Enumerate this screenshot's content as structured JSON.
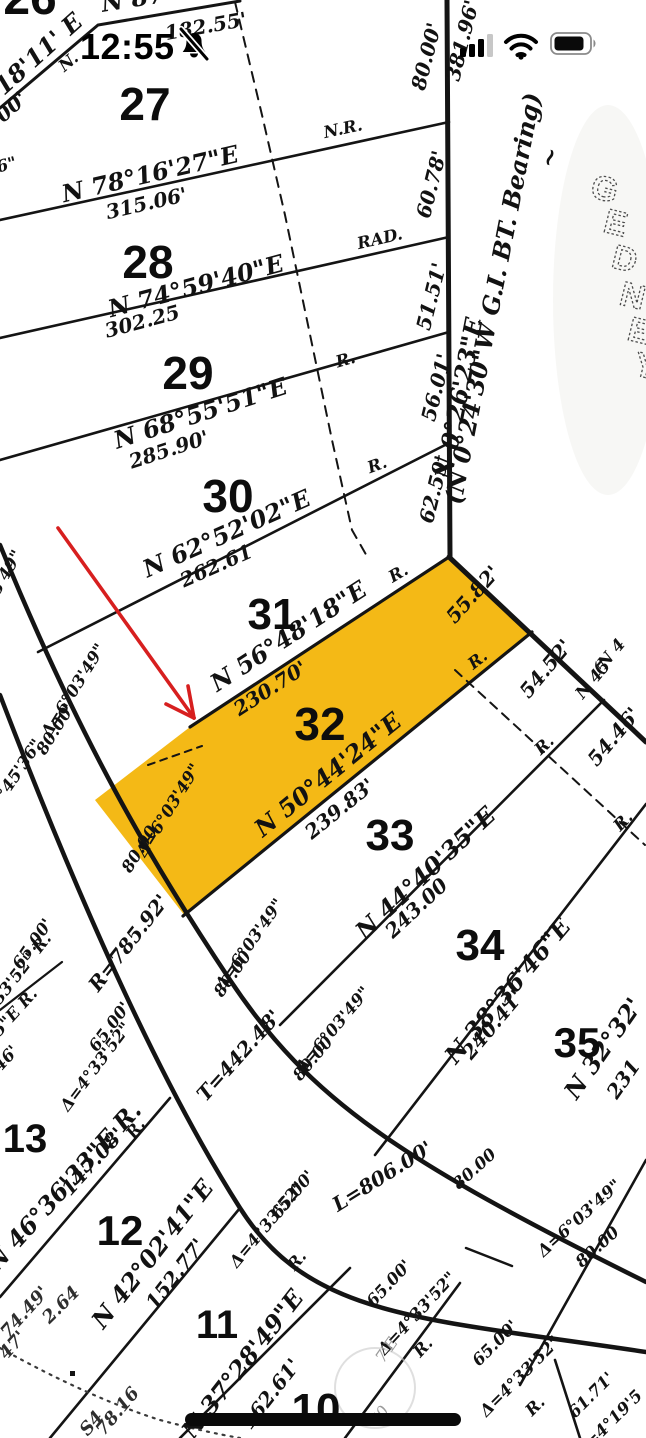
{
  "status_bar": {
    "time": "12:55",
    "icons": [
      "bell-slash-icon",
      "cellular-signal-icon",
      "wifi-icon",
      "battery-icon"
    ]
  },
  "map": {
    "type": "survey-plat-map",
    "highlighted_lot": "32",
    "highlight_color": "#F4B60C",
    "arrow_color": "#D71F1F",
    "street_letters": [
      {
        "t": "G",
        "x": 602,
        "y": 200,
        "r": 14
      },
      {
        "t": "E",
        "x": 613,
        "y": 234,
        "r": 14
      },
      {
        "t": "D",
        "x": 622,
        "y": 270,
        "r": 14
      },
      {
        "t": "N",
        "x": 630,
        "y": 307,
        "r": 14
      },
      {
        "t": "E",
        "x": 637,
        "y": 342,
        "r": 14
      },
      {
        "t": "Y",
        "x": 643,
        "y": 377,
        "r": 14
      }
    ],
    "lots": [
      {
        "t": "26",
        "x": 30,
        "y": 14,
        "s": 48
      },
      {
        "t": "27",
        "x": 145,
        "y": 120,
        "s": 46
      },
      {
        "t": "28",
        "x": 148,
        "y": 278,
        "s": 46
      },
      {
        "t": "29",
        "x": 188,
        "y": 389,
        "s": 46
      },
      {
        "t": "30",
        "x": 228,
        "y": 512,
        "s": 46
      },
      {
        "t": "31",
        "x": 272,
        "y": 629,
        "s": 44
      },
      {
        "t": "32",
        "x": 320,
        "y": 740,
        "s": 46
      },
      {
        "t": "33",
        "x": 390,
        "y": 850,
        "s": 44
      },
      {
        "t": "34",
        "x": 480,
        "y": 960,
        "s": 44
      },
      {
        "t": "35",
        "x": 577,
        "y": 1057,
        "s": 42
      },
      {
        "t": "13",
        "x": 25,
        "y": 1152,
        "s": 40
      },
      {
        "t": "12",
        "x": 120,
        "y": 1245,
        "s": 42
      },
      {
        "t": "11",
        "x": 217,
        "y": 1338,
        "s": 40
      },
      {
        "t": "10",
        "x": 316,
        "y": 1424,
        "s": 44
      }
    ],
    "texts": [
      {
        "t": "N 87°",
        "x": 140,
        "y": 6,
        "r": -9,
        "c": "b"
      },
      {
        "t": "182.55'",
        "x": 207,
        "y": 33,
        "r": -10,
        "c": "l"
      },
      {
        "t": "18'11' E",
        "x": 44,
        "y": 60,
        "r": -42,
        "c": "b"
      },
      {
        "t": "00'",
        "x": 16,
        "y": 112,
        "r": -42,
        "c": "l"
      },
      {
        "t": "N.",
        "x": 72,
        "y": 66,
        "r": -40,
        "c": "s"
      },
      {
        "t": "6\"",
        "x": 8,
        "y": 170,
        "r": -15,
        "c": "s"
      },
      {
        "t": "N 78°16'27\"E",
        "x": 152,
        "y": 182,
        "r": -13,
        "c": "b"
      },
      {
        "t": "315.06'",
        "x": 148,
        "y": 210,
        "r": -13,
        "c": "l"
      },
      {
        "t": "N.R.",
        "x": 344,
        "y": 134,
        "r": -12,
        "c": "s"
      },
      {
        "t": "N 74°59'40\"E",
        "x": 198,
        "y": 294,
        "r": -15,
        "c": "b"
      },
      {
        "t": "302.25",
        "x": 144,
        "y": 328,
        "r": -15,
        "c": "l"
      },
      {
        "t": "RAD.",
        "x": 381,
        "y": 244,
        "r": -13,
        "c": "s"
      },
      {
        "t": "N 68°55'51\"E",
        "x": 203,
        "y": 421,
        "r": -18,
        "c": "b"
      },
      {
        "t": "285.90'",
        "x": 171,
        "y": 456,
        "r": -18,
        "c": "l"
      },
      {
        "t": "R.",
        "x": 347,
        "y": 365,
        "r": -16,
        "c": "s"
      },
      {
        "t": "N 62°52'02\"E",
        "x": 230,
        "y": 541,
        "r": -24,
        "c": "b"
      },
      {
        "t": "262.61",
        "x": 219,
        "y": 572,
        "r": -24,
        "c": "l"
      },
      {
        "t": "R.",
        "x": 379,
        "y": 470,
        "r": -20,
        "c": "s"
      },
      {
        "t": "N 56°48'18\"E",
        "x": 293,
        "y": 643,
        "r": -33,
        "c": "b"
      },
      {
        "t": "230.70'",
        "x": 274,
        "y": 694,
        "r": -33,
        "c": "l"
      },
      {
        "t": "R.",
        "x": 401,
        "y": 578,
        "r": -30,
        "c": "s"
      },
      {
        "t": "N 50°44'24\"E",
        "x": 333,
        "y": 781,
        "r": -39,
        "c": "b"
      },
      {
        "t": "239.83'",
        "x": 344,
        "y": 814,
        "r": -39,
        "c": "l"
      },
      {
        "t": "R.",
        "x": 481,
        "y": 664,
        "r": -38,
        "c": "s"
      },
      {
        "t": "N 44°40'35\"E",
        "x": 431,
        "y": 879,
        "r": -43,
        "c": "b"
      },
      {
        "t": "243.00",
        "x": 421,
        "y": 913,
        "r": -43,
        "c": "l"
      },
      {
        "t": "R.",
        "x": 548,
        "y": 749,
        "r": -43,
        "c": "s"
      },
      {
        "t": "N 38°36'46\"E",
        "x": 514,
        "y": 996,
        "r": -50,
        "c": "b"
      },
      {
        "t": "240.41'",
        "x": 498,
        "y": 1029,
        "r": -50,
        "c": "l"
      },
      {
        "t": "R.",
        "x": 627,
        "y": 825,
        "r": -46,
        "c": "s"
      },
      {
        "t": "N 32°32'",
        "x": 610,
        "y": 1053,
        "r": -55,
        "c": "b"
      },
      {
        "t": "231",
        "x": 629,
        "y": 1083,
        "r": -55,
        "c": "l"
      },
      {
        "t": "55.82'",
        "x": 478,
        "y": 599,
        "r": -48,
        "c": "l"
      },
      {
        "t": "54.52'",
        "x": 551,
        "y": 673,
        "r": -50,
        "c": "l"
      },
      {
        "t": "54.46'",
        "x": 619,
        "y": 741,
        "r": -50,
        "c": "l"
      },
      {
        "t": "(N 4",
        "x": 613,
        "y": 660,
        "r": -50,
        "c": "s"
      },
      {
        "t": "N 45",
        "x": 597,
        "y": 683,
        "r": -50,
        "c": "s"
      },
      {
        "t": "80.00'",
        "x": 433,
        "y": 58,
        "r": -76,
        "c": "l"
      },
      {
        "t": "60.78'",
        "x": 438,
        "y": 186,
        "r": -76,
        "c": "l"
      },
      {
        "t": "51.51'",
        "x": 438,
        "y": 298,
        "r": -76,
        "c": "l"
      },
      {
        "t": "56.01'",
        "x": 443,
        "y": 389,
        "r": -76,
        "c": "l"
      },
      {
        "t": "62.59'",
        "x": 441,
        "y": 491,
        "r": -76,
        "c": "l"
      },
      {
        "t": "381.96'",
        "x": 469,
        "y": 42,
        "r": -76,
        "c": "l"
      },
      {
        "t": "N 0°26'23\"E",
        "x": 467,
        "y": 400,
        "r": -79,
        "c": "b"
      },
      {
        "t": "(N 0°24'30\"W   G.I. BT. Bearing)",
        "x": 501,
        "y": 300,
        "r": -79,
        "c": "b"
      },
      {
        "t": "~",
        "x": 557,
        "y": 160,
        "r": -70,
        "c": "b"
      },
      {
        "t": "R=785.92'",
        "x": 134,
        "y": 947,
        "r": -52,
        "c": "l"
      },
      {
        "t": "T=442.48'",
        "x": 244,
        "y": 1060,
        "r": -48,
        "c": "l"
      },
      {
        "t": "L=806.00'",
        "x": 386,
        "y": 1182,
        "r": -32,
        "c": "l"
      },
      {
        "t": "Δ=6°03'49\"",
        "x": 78,
        "y": 693,
        "r": -58,
        "c": "s"
      },
      {
        "t": "80.00'",
        "x": 60,
        "y": 732,
        "r": -58,
        "c": "s"
      },
      {
        "t": "Δ=6°03'49\"",
        "x": 173,
        "y": 813,
        "r": -58,
        "c": "s"
      },
      {
        "t": "80.00",
        "x": 144,
        "y": 852,
        "r": -58,
        "c": "s"
      },
      {
        "t": "Δ=6°03'49\"",
        "x": 254,
        "y": 947,
        "r": -55,
        "c": "s"
      },
      {
        "t": "80.00",
        "x": 237,
        "y": 977,
        "r": -55,
        "c": "s"
      },
      {
        "t": "Δ=6°03'49\"",
        "x": 337,
        "y": 1033,
        "r": -50,
        "c": "s"
      },
      {
        "t": "80.00",
        "x": 317,
        "y": 1062,
        "r": -50,
        "c": "s"
      },
      {
        "t": "80.00",
        "x": 478,
        "y": 1173,
        "r": -42,
        "c": "s"
      },
      {
        "t": "Δ=6°03'49\"",
        "x": 583,
        "y": 1222,
        "r": -42,
        "c": "s"
      },
      {
        "t": "80.00",
        "x": 601,
        "y": 1251,
        "r": -42,
        "c": "s"
      },
      {
        "t": "03'49\"",
        "x": 8,
        "y": 580,
        "r": -60,
        "c": "s"
      },
      {
        "t": "°45'36\"",
        "x": 24,
        "y": 772,
        "r": -56,
        "c": "s"
      },
      {
        "t": "65.00'",
        "x": 37,
        "y": 947,
        "r": -55,
        "c": "s"
      },
      {
        "t": "33'52\" R.",
        "x": 26,
        "y": 972,
        "r": -52,
        "c": "s"
      },
      {
        "t": "25\"E R.",
        "x": 15,
        "y": 1020,
        "r": -48,
        "c": "s"
      },
      {
        "t": "46'",
        "x": 10,
        "y": 1062,
        "r": -48,
        "c": "s"
      },
      {
        "t": "65.00'",
        "x": 114,
        "y": 1030,
        "r": -53,
        "c": "s"
      },
      {
        "t": "Δ=4°33'52\"",
        "x": 100,
        "y": 1070,
        "r": -53,
        "c": "s"
      },
      {
        "t": "R.",
        "x": 140,
        "y": 1132,
        "r": -53,
        "c": "s"
      },
      {
        "t": "N 46°36'33\"E R.",
        "x": 70,
        "y": 1192,
        "r": -48,
        "c": "b"
      },
      {
        "t": "147.08'",
        "x": 98,
        "y": 1166,
        "r": -48,
        "c": "l"
      },
      {
        "t": "N 42°02'41\"E",
        "x": 159,
        "y": 1259,
        "r": -52,
        "c": "b"
      },
      {
        "t": "152.77'",
        "x": 181,
        "y": 1278,
        "r": -52,
        "c": "l"
      },
      {
        "t": "65.00'",
        "x": 297,
        "y": 1198,
        "r": -50,
        "c": "s"
      },
      {
        "t": "Δ=4°33'52\"",
        "x": 271,
        "y": 1228,
        "r": -50,
        "c": "s"
      },
      {
        "t": "R.",
        "x": 301,
        "y": 1264,
        "r": -50,
        "c": "s"
      },
      {
        "t": "N 37°28'49\"E",
        "x": 249,
        "y": 1369,
        "r": -52,
        "c": "b"
      },
      {
        "t": "162.61'",
        "x": 276,
        "y": 1398,
        "r": -52,
        "c": "l"
      },
      {
        "t": "65.00'",
        "x": 393,
        "y": 1287,
        "r": -47,
        "c": "s"
      },
      {
        "t": "Δ=4°33'52\"",
        "x": 421,
        "y": 1317,
        "r": -47,
        "c": "s"
      },
      {
        "t": "R.",
        "x": 427,
        "y": 1351,
        "r": -47,
        "c": "s"
      },
      {
        "t": "65.00'",
        "x": 499,
        "y": 1347,
        "r": -45,
        "c": "s"
      },
      {
        "t": "Δ=4°33'52\"",
        "x": 524,
        "y": 1380,
        "r": -45,
        "c": "s"
      },
      {
        "t": "R.",
        "x": 539,
        "y": 1410,
        "r": -45,
        "c": "s"
      },
      {
        "t": "61.71'",
        "x": 595,
        "y": 1399,
        "r": -45,
        "c": "s"
      },
      {
        "t": "Δ=4°19'5",
        "x": 613,
        "y": 1427,
        "r": -45,
        "c": "s"
      },
      {
        "t": "2.64",
        "x": 65,
        "y": 1309,
        "r": -45,
        "c": "p"
      },
      {
        "t": "74.49'",
        "x": 29,
        "y": 1316,
        "r": -48,
        "c": "p"
      },
      {
        "t": "47'",
        "x": 17,
        "y": 1349,
        "r": -48,
        "c": "p"
      },
      {
        "t": "78.16",
        "x": 122,
        "y": 1415,
        "r": -50,
        "c": "p"
      },
      {
        "t": "S4",
        "x": 96,
        "y": 1427,
        "r": -50,
        "c": "p"
      },
      {
        "t": "7'E",
        "x": 391,
        "y": 1353,
        "r": -55,
        "c": "f"
      },
      {
        "t": "70",
        "x": 384,
        "y": 1419,
        "r": -55,
        "c": "f"
      }
    ]
  }
}
